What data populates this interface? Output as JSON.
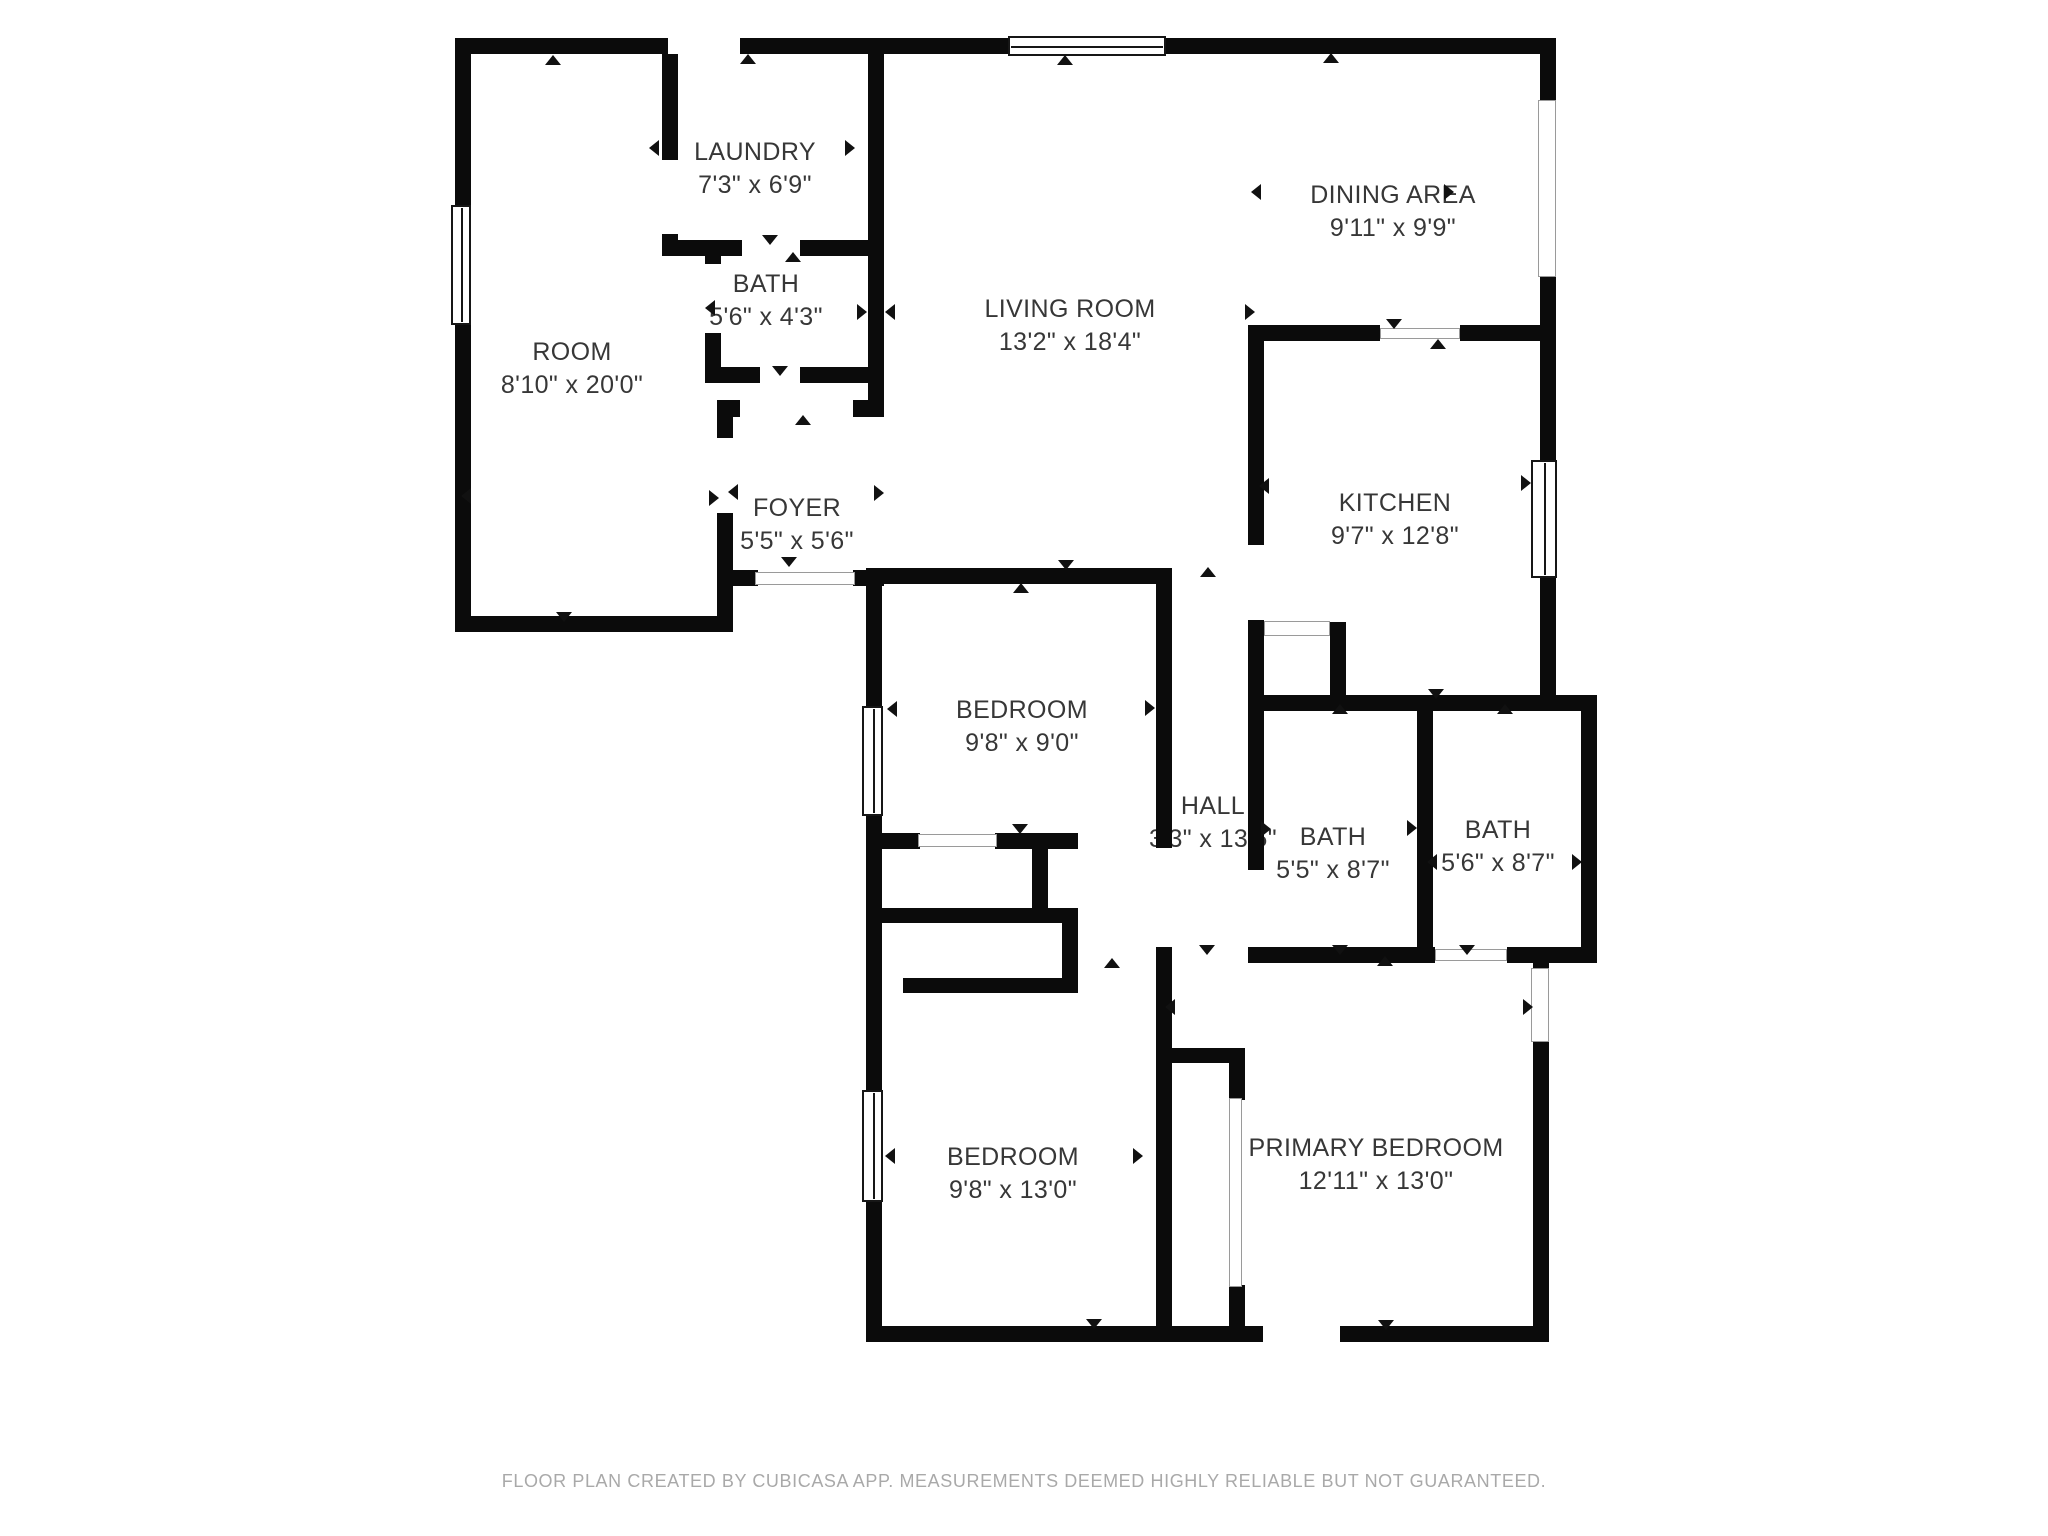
{
  "diagram": {
    "type": "floor-plan",
    "colors": {
      "wall": "#0b0b0b",
      "label_text": "#373737",
      "footer_text": "#a9a9a9",
      "background": "#ffffff"
    }
  },
  "rooms": [
    {
      "name": "ROOM",
      "dims": "8'10\" x 20'0\""
    },
    {
      "name": "LAUNDRY",
      "dims": "7'3\" x 6'9\""
    },
    {
      "name": "BATH",
      "dims": "5'6\" x 4'3\""
    },
    {
      "name": "FOYER",
      "dims": "5'5\" x 5'6\""
    },
    {
      "name": "LIVING ROOM",
      "dims": "13'2\" x 18'4\""
    },
    {
      "name": "DINING AREA",
      "dims": "9'11\" x 9'9\""
    },
    {
      "name": "KITCHEN",
      "dims": "9'7\" x 12'8\""
    },
    {
      "name": "BEDROOM",
      "dims": "9'8\" x 9'0\""
    },
    {
      "name": "HALL",
      "dims": "3'3\" x 13'5\""
    },
    {
      "name": "BATH",
      "dims": "5'5\" x 8'7\""
    },
    {
      "name": "BATH",
      "dims": "5'6\" x 8'7\""
    },
    {
      "name": "BEDROOM",
      "dims": "9'8\" x 13'0\""
    },
    {
      "name": "PRIMARY BEDROOM",
      "dims": "12'11\" x 13'0\""
    }
  ],
  "footer": {
    "text": "FLOOR PLAN CREATED BY CUBICASA APP. MEASUREMENTS DEEMED HIGHLY RELIABLE BUT NOT GUARANTEED."
  }
}
